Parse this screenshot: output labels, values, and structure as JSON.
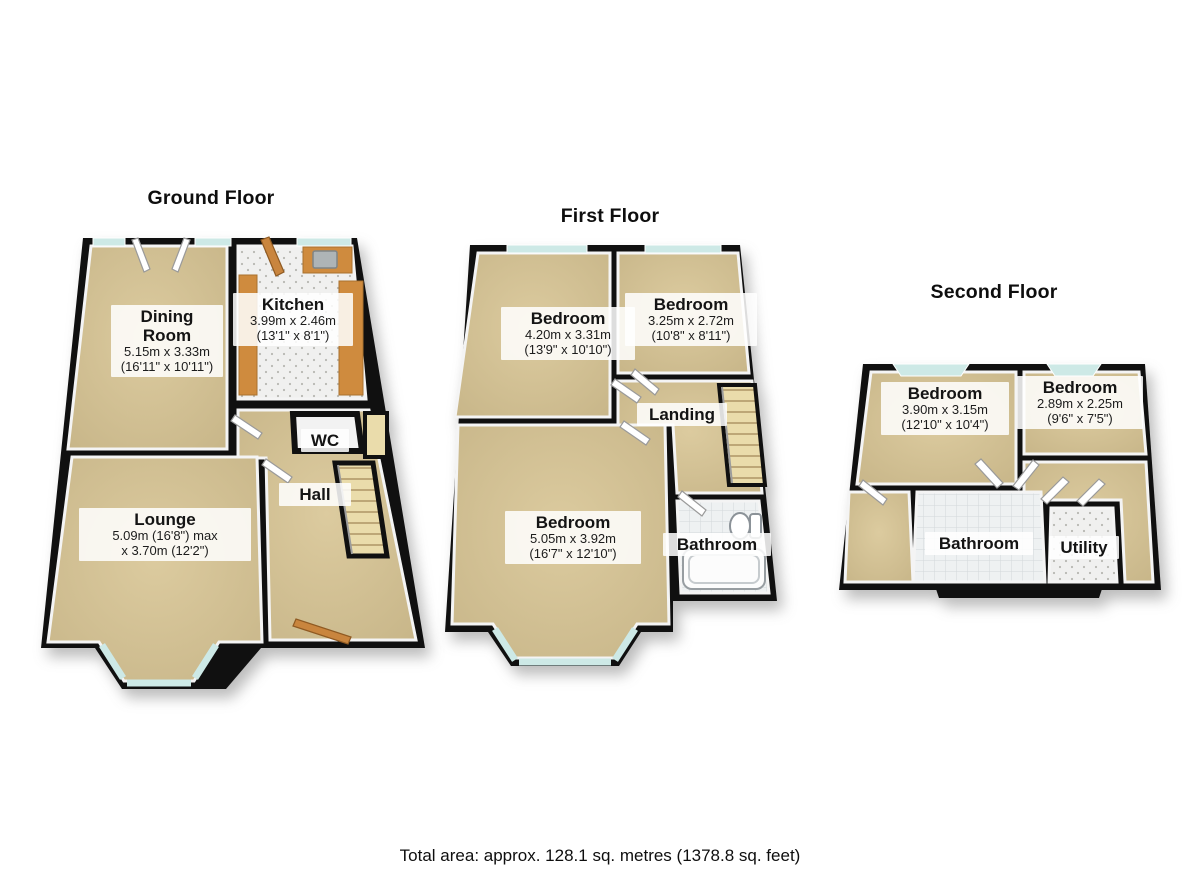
{
  "floors": [
    {
      "title": "Ground Floor",
      "rooms": [
        {
          "name": "Dining Room",
          "dim_metric": "5.15m x 3.33m",
          "dim_imperial": "(16'11\" x 10'11\")"
        },
        {
          "name": "Kitchen",
          "dim_metric": "3.99m x 2.46m",
          "dim_imperial": "(13'1\" x 8'1\")"
        },
        {
          "name": "WC"
        },
        {
          "name": "Hall"
        },
        {
          "name": "Lounge",
          "dim_metric": "5.09m (16'8\") max",
          "dim_imperial": "x 3.70m (12'2\")"
        }
      ]
    },
    {
      "title": "First Floor",
      "rooms": [
        {
          "name": "Bedroom",
          "dim_metric": "4.20m x 3.31m",
          "dim_imperial": "(13'9\" x 10'10\")"
        },
        {
          "name": "Bedroom",
          "dim_metric": "3.25m x 2.72m",
          "dim_imperial": "(10'8\" x 8'11\")"
        },
        {
          "name": "Landing"
        },
        {
          "name": "Bedroom",
          "dim_metric": "5.05m x 3.92m",
          "dim_imperial": "(16'7\" x 12'10\")"
        },
        {
          "name": "Bathroom"
        }
      ]
    },
    {
      "title": "Second Floor",
      "rooms": [
        {
          "name": "Bedroom",
          "dim_metric": "3.90m x 3.15m",
          "dim_imperial": "(12'10\" x 10'4\")"
        },
        {
          "name": "Bedroom",
          "dim_metric": "2.89m x 2.25m",
          "dim_imperial": "(9'6\" x 7'5\")"
        },
        {
          "name": "Bathroom"
        },
        {
          "name": "Utility"
        }
      ]
    }
  ],
  "footer": {
    "total_area": "Total area: approx. 128.1 sq. metres (1378.8 sq. feet)"
  },
  "colors": {
    "wall": "#101010",
    "carpet": "#d3c299",
    "glass": "#cde9e6",
    "stairs": "#eadcab",
    "wood": "#c9853e",
    "tile": "#f0f0ef",
    "bath_tile": "#eef1f2",
    "label_bg": "rgba(255,255,255,0.86)"
  }
}
